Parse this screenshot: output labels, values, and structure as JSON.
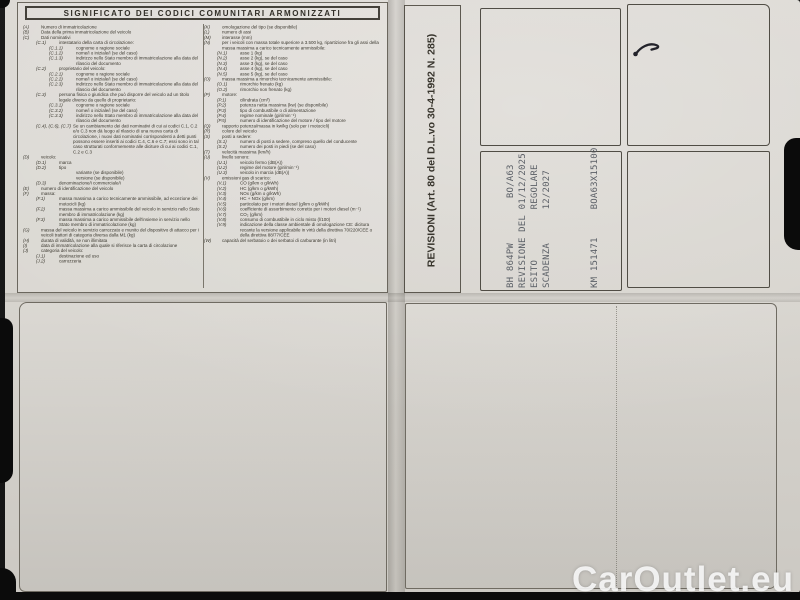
{
  "watermark": "CarOutlet.eu",
  "colors": {
    "backdrop": "#0b0b0b",
    "paper": "#d7d4ce",
    "ink": "#3b382f",
    "stamp_ink": "#51565e",
    "watermark_text": "#fafafa"
  },
  "legend": {
    "title": "SIGNIFICATO DEI CODICI COMUNITARI ARMONIZZATI",
    "left_column": [
      {
        "code": "(A)",
        "text": "Numero di immatricolazione",
        "indent": 0
      },
      {
        "code": "(B)",
        "text": "Data della prima immatricolazione del veicolo",
        "indent": 0
      },
      {
        "code": "(C)",
        "text": "Dati nominativi",
        "indent": 0
      },
      {
        "code": "(C.1)",
        "text": "intestatario della carta di circolazione:",
        "indent": 1
      },
      {
        "code": "(C.1.1)",
        "text": "cognome o ragione sociale",
        "indent": 2
      },
      {
        "code": "(C.1.2)",
        "text": "nome/i o iniziale/i (se del caso)",
        "indent": 2
      },
      {
        "code": "(C.1.3)",
        "text": "indirizzo nello Stato membro di immatricolazione alla data del rilascio del documento",
        "indent": 2
      },
      {
        "code": "(C.2)",
        "text": "proprietario del veicolo:",
        "indent": 1
      },
      {
        "code": "(C.2.1)",
        "text": "cognome o ragione sociale",
        "indent": 2
      },
      {
        "code": "(C.2.2)",
        "text": "nome/i o iniziale/i (se del caso)",
        "indent": 2
      },
      {
        "code": "(C.2.3)",
        "text": "indirizzo nello Stato membro di immatricolazione alla data del rilascio del documento",
        "indent": 2
      },
      {
        "code": "(C.3)",
        "text": "persona fisica o giuridica che può disporre del veicolo ad un titolo legale diverso da quello di proprietario:",
        "indent": 1
      },
      {
        "code": "(C.3.1)",
        "text": "cognome o ragione sociale",
        "indent": 2
      },
      {
        "code": "(C.3.2)",
        "text": "nome/i o iniziale/i (se del caso)",
        "indent": 2
      },
      {
        "code": "(C.3.3)",
        "text": "indirizzo nello Stato membro di immatricolazione alla data del rilascio del documento",
        "indent": 2
      },
      {
        "code": "(C.4), (C.6), (C.7)",
        "text": "Se un cambiamento dei dati nominativi di cui ai codici C.1, C.2 e/o C.3 non dà luogo al rilascio di una nuova carta di circolazione, i nuovi dati nominativi corrispondenti a detti punti possono essere inseriti ai codici C.4, C.6 e C.7; essi sono in tal caso strutturati conformemente alle diciture di cui ai codici C.1, C.2 e C.3",
        "indent": 1,
        "wide": true
      },
      {
        "code": "(D)",
        "text": "veicolo:",
        "indent": 0
      },
      {
        "code": "(D.1)",
        "text": "marca",
        "indent": 1
      },
      {
        "code": "(D.2)",
        "text": "tipo",
        "indent": 1
      },
      {
        "code": "",
        "text": "variante (se disponibile)",
        "indent": 2
      },
      {
        "code": "",
        "text": "versione (se disponibile)",
        "indent": 2
      },
      {
        "code": "(D.3)",
        "text": "denominazione/i commerciale/i",
        "indent": 1
      },
      {
        "code": "(E)",
        "text": "numero di identificazione del veicolo",
        "indent": 0
      },
      {
        "code": "(F)",
        "text": "massa:",
        "indent": 0
      },
      {
        "code": "(F.1)",
        "text": "massa massima a carico tecnicamente ammissibile, ad eccezione dei motocicli (kg)",
        "indent": 1
      },
      {
        "code": "(F.2)",
        "text": "massa massima a carico ammissibile del veicolo in servizio nello Stato membro di immatricolazione (kg)",
        "indent": 1
      },
      {
        "code": "(F.3)",
        "text": "massa massima a carico ammissibile dell'insieme in servizio nello Stato membro di immatricolazione (kg)",
        "indent": 1
      },
      {
        "code": "(G)",
        "text": "massa del veicolo in servizio carrozzato e munito del dispositivo di attacco per i veicoli trattori di categoria diversa dalla M1 (kg)",
        "indent": 0
      },
      {
        "code": "(H)",
        "text": "durata di validità, se non illimitata",
        "indent": 0
      },
      {
        "code": "(I)",
        "text": "data di immatricolazione alla quale si riferisce la carta di circolazione",
        "indent": 0
      },
      {
        "code": "(J)",
        "text": "categoria del veicolo:",
        "indent": 0
      },
      {
        "code": "(J.1)",
        "text": "destinazione ed uso",
        "indent": 1
      },
      {
        "code": "(J.2)",
        "text": "carrozzeria",
        "indent": 1
      }
    ],
    "right_column": [
      {
        "code": "(K)",
        "text": "omologazione del tipo (se disponibile)",
        "indent": 0
      },
      {
        "code": "(L)",
        "text": "numero di assi",
        "indent": 0
      },
      {
        "code": "(M)",
        "text": "interasse (mm)",
        "indent": 0
      },
      {
        "code": "(N)",
        "text": "per i veicoli con massa totale superiore a 3.500 kg, ripartizione fra gli assi della massa massima a carico tecnicamente ammissibile:",
        "indent": 0
      },
      {
        "code": "(N.1)",
        "text": "asse 1 (kg)",
        "indent": 1
      },
      {
        "code": "(N.2)",
        "text": "asse 2 (kg), se del caso",
        "indent": 1
      },
      {
        "code": "(N.3)",
        "text": "asse 3 (kg), se del caso",
        "indent": 1
      },
      {
        "code": "(N.4)",
        "text": "asse 4 (kg), se del caso",
        "indent": 1
      },
      {
        "code": "(N.5)",
        "text": "asse 5 (kg), se del caso",
        "indent": 1
      },
      {
        "code": "(O)",
        "text": "massa massima a rimorchio tecnicamente ammissibile:",
        "indent": 0
      },
      {
        "code": "(O.1)",
        "text": "rimorchio frenato (kg)",
        "indent": 1
      },
      {
        "code": "(O.2)",
        "text": "rimorchio non frenato (kg)",
        "indent": 1
      },
      {
        "code": "(P)",
        "text": "motore:",
        "indent": 0
      },
      {
        "code": "(P.1)",
        "text": "cilindrata (cm³)",
        "indent": 1
      },
      {
        "code": "(P.2)",
        "text": "potenza netta massima (kw) (se disponibile)",
        "indent": 1
      },
      {
        "code": "(P.3)",
        "text": "tipo di combustibile o di alimentazione",
        "indent": 1
      },
      {
        "code": "(P.4)",
        "text": "regime nominale (giri/min⁻¹)",
        "indent": 1
      },
      {
        "code": "(P.5)",
        "text": "numero di identificazione del motore / tipo del motore",
        "indent": 1
      },
      {
        "code": "(Q)",
        "text": "rapporto potenza/massa in kw/kg (solo per i motocicli)",
        "indent": 0
      },
      {
        "code": "(R)",
        "text": "colore del veicolo",
        "indent": 0
      },
      {
        "code": "(S)",
        "text": "posti a sedere:",
        "indent": 0
      },
      {
        "code": "(S.1)",
        "text": "numero di posti a sedere, compreso quello del conducente",
        "indent": 1
      },
      {
        "code": "(S.2)",
        "text": "numero dei posti in piedi (se del caso)",
        "indent": 1
      },
      {
        "code": "(T)",
        "text": "velocità massima (km/h)",
        "indent": 0
      },
      {
        "code": "(U)",
        "text": "livello sonoro:",
        "indent": 0
      },
      {
        "code": "(U.1)",
        "text": "veicolo fermo (dB(A))",
        "indent": 1
      },
      {
        "code": "(U.2)",
        "text": "regime del motore (giri/min⁻¹)",
        "indent": 1
      },
      {
        "code": "(U.3)",
        "text": "veicolo in marcia (dB(A))",
        "indent": 1
      },
      {
        "code": "(V)",
        "text": "emissioni gas di scarico:",
        "indent": 0
      },
      {
        "code": "(V.1)",
        "text": "CO (g/km o g/kWh)",
        "indent": 1
      },
      {
        "code": "(V.2)",
        "text": "HC (g/km o g/kWh)",
        "indent": 1
      },
      {
        "code": "(V.3)",
        "text": "NOx (g/km o g/kWh)",
        "indent": 1
      },
      {
        "code": "(V.4)",
        "text": "HC + NOx (g/km)",
        "indent": 1
      },
      {
        "code": "(V.5)",
        "text": "particolato per i motori diesel (g/km o g/kWh)",
        "indent": 1
      },
      {
        "code": "(V.6)",
        "text": "coefficiente di assorbimento corretto per i motori diesel (m⁻¹)",
        "indent": 1
      },
      {
        "code": "(V.7)",
        "text": "CO₂ (g/km)",
        "indent": 1
      },
      {
        "code": "(V.8)",
        "text": "consumo di combustibile in ciclo misto (l/100)",
        "indent": 1
      },
      {
        "code": "(V.9)",
        "text": "indicazione della classe ambientale di omologazione CE: dicitura recante la versione applicabile in virtù della direttiva 70/220/CEE o della direttiva 88/77/CEE",
        "indent": 1
      },
      {
        "code": "(W)",
        "text": "capacità del serbatoio o dei serbatoi di carburante (in litri)",
        "indent": 0
      }
    ]
  },
  "revisioni": {
    "title": "REVISIONI (Art. 80 del D.L.vo 30-4-1992 N. 285)",
    "stamp_lines": [
      "BH 864PW        BO/A63",
      "REVISIONE DEL 01/12/2025",
      "ESITO         REGOLARE",
      "SCADENZA      12/2027",
      "",
      "",
      "",
      "KM 151471     BOA63X15100"
    ]
  }
}
